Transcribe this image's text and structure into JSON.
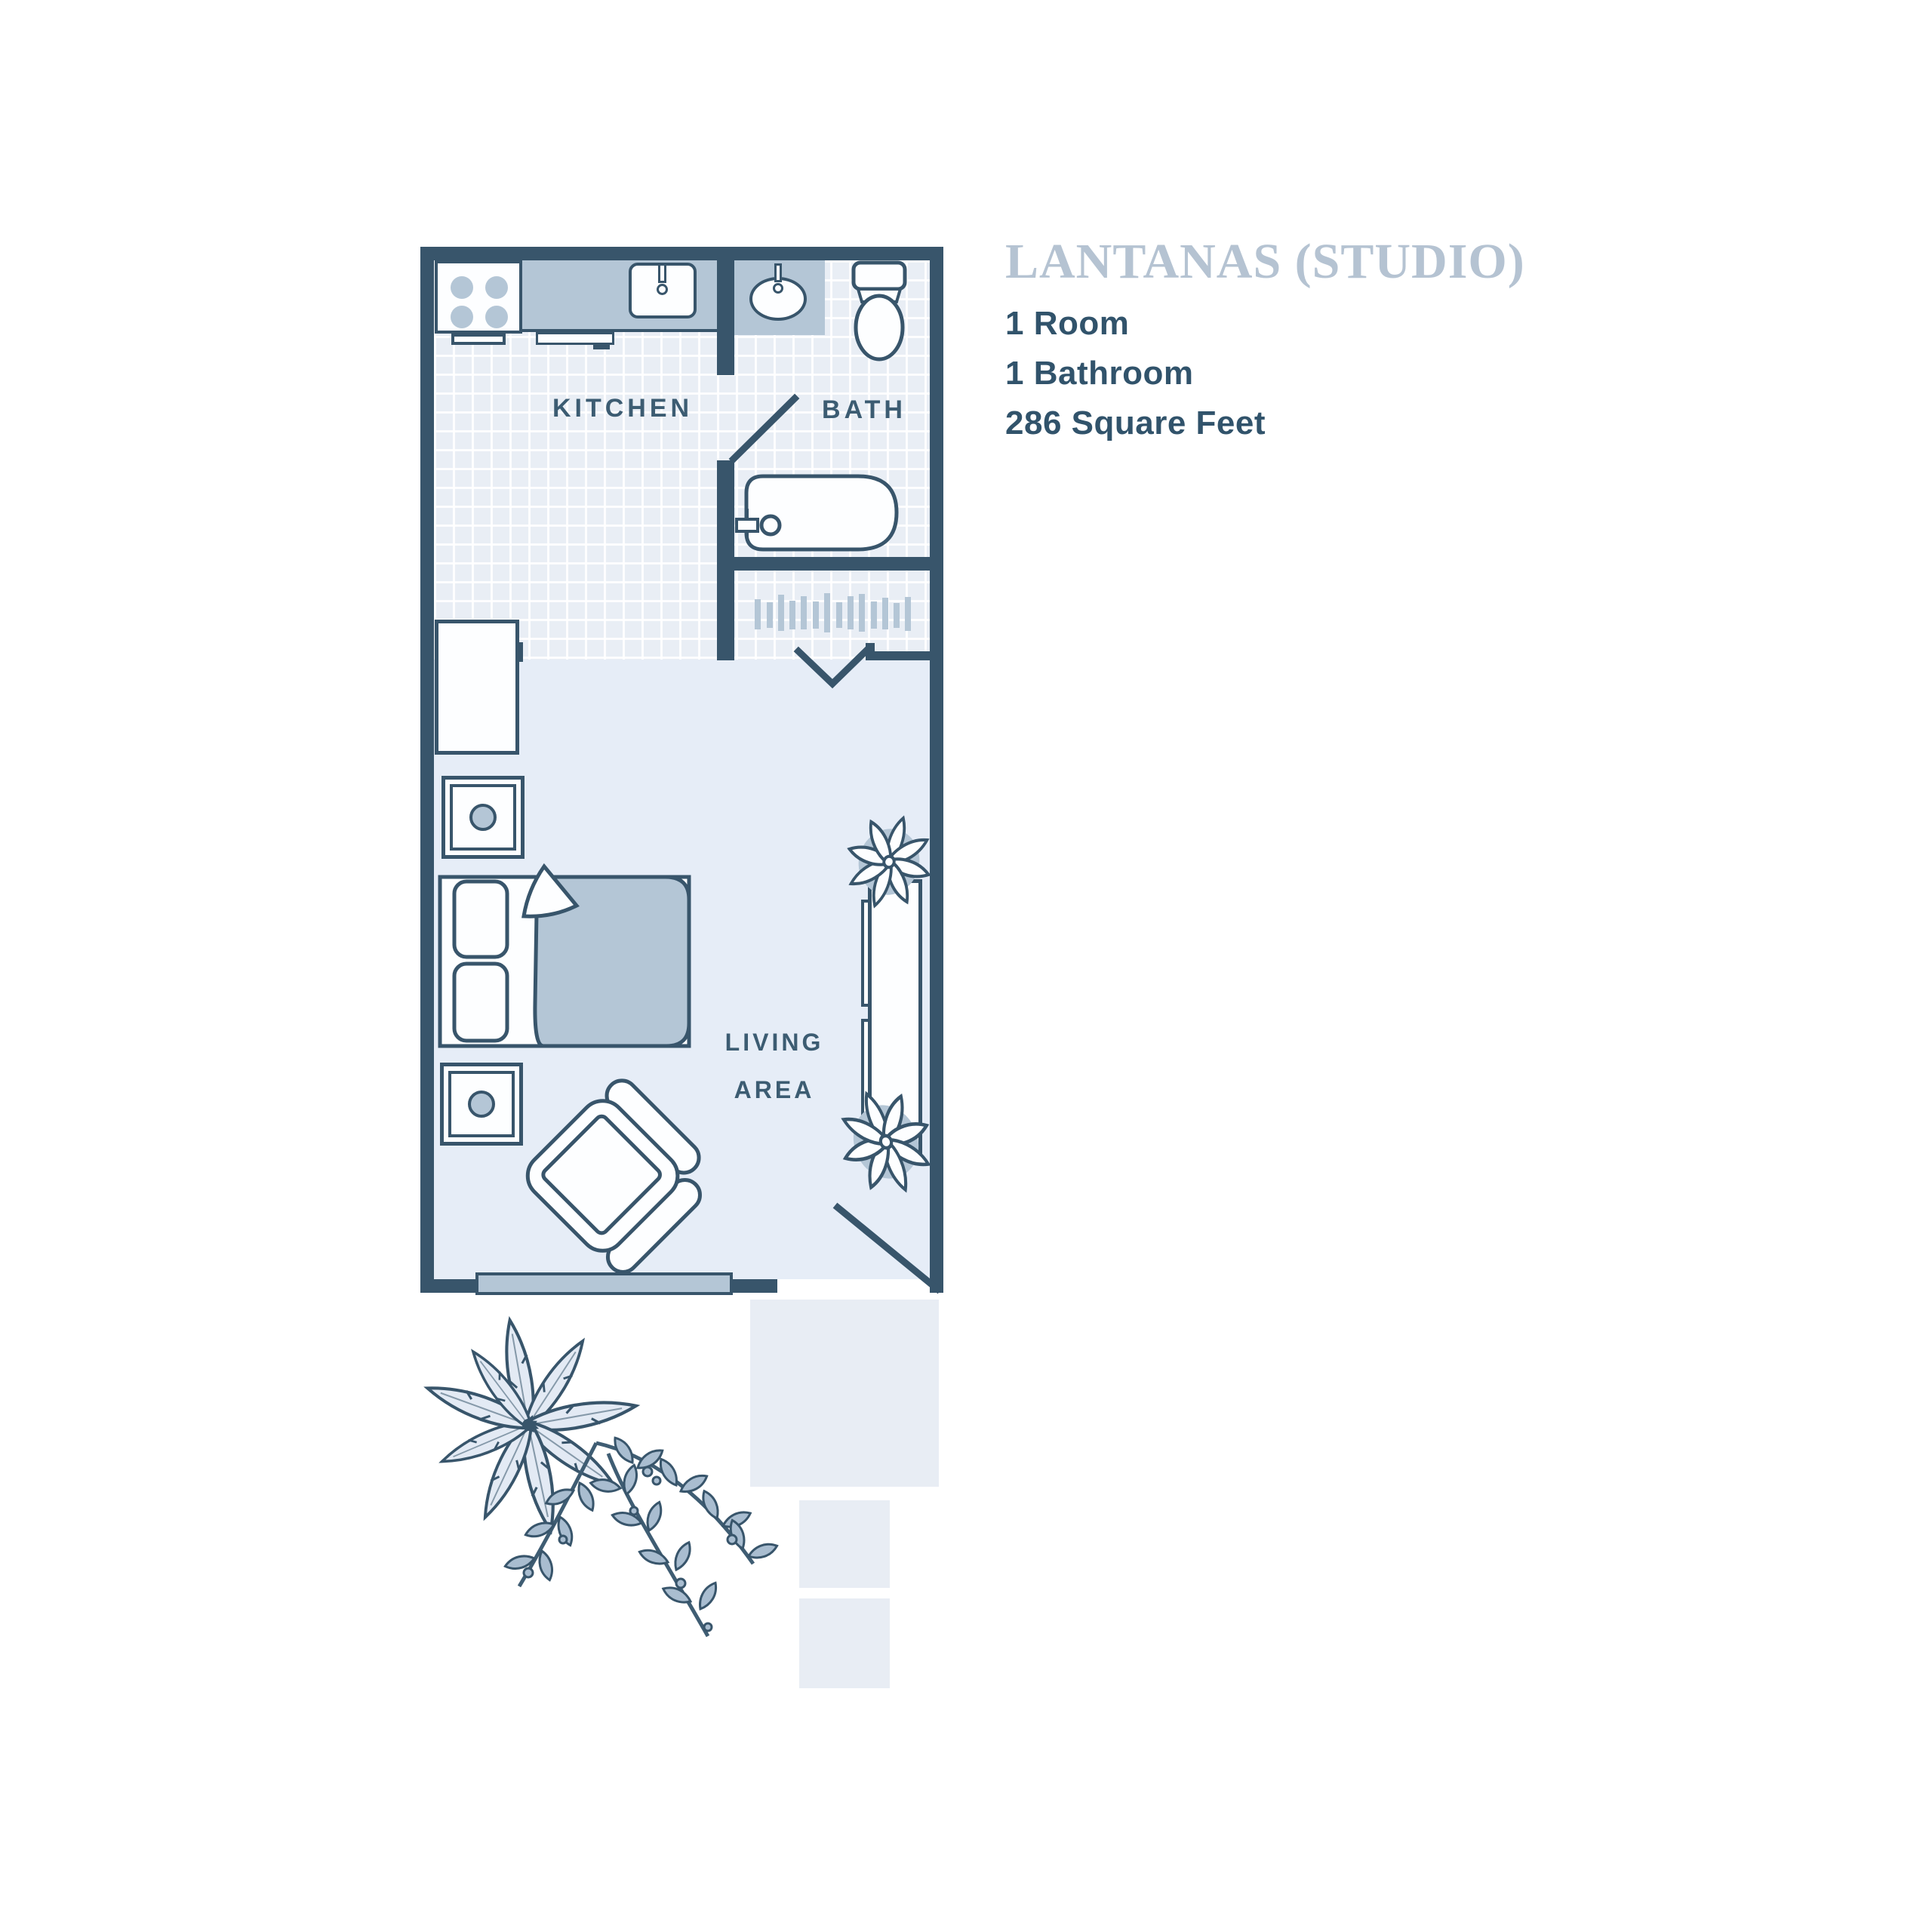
{
  "info_panel": {
    "title": "LANTANAS (STUDIO)",
    "details": [
      "1 Room",
      "1 Bathroom",
      "286 Square Feet"
    ]
  },
  "floor_plan": {
    "labels": {
      "kitchen": "KITCHEN",
      "bath": "BATH",
      "living_line1": "LIVING",
      "living_line2": "AREA"
    },
    "fixtures": [
      "stove-icon",
      "kitchen-sink-icon",
      "dishwasher-icon",
      "refrigerator-icon",
      "bathroom-sink-icon",
      "toilet-icon",
      "bathtub-icon",
      "closet-rod-icon",
      "bed-icon",
      "nightstand-icon",
      "dresser-icon",
      "armchair-icon",
      "plant-icon",
      "window-icon",
      "door-icon"
    ]
  },
  "colors": {
    "wall": "#38556b",
    "outline": "#38556b",
    "furniture_gray": "#b4c6d6",
    "tile_background": "#e9eef5",
    "living_floor": "#e6edf7",
    "patio": "#e8edf4",
    "title_text": "#b5c3d2",
    "detail_text": "#31536b",
    "label_text": "#3c5c72",
    "palm_leaf": "#e3eaf4",
    "fern_leaf": "#a9bdd0"
  }
}
